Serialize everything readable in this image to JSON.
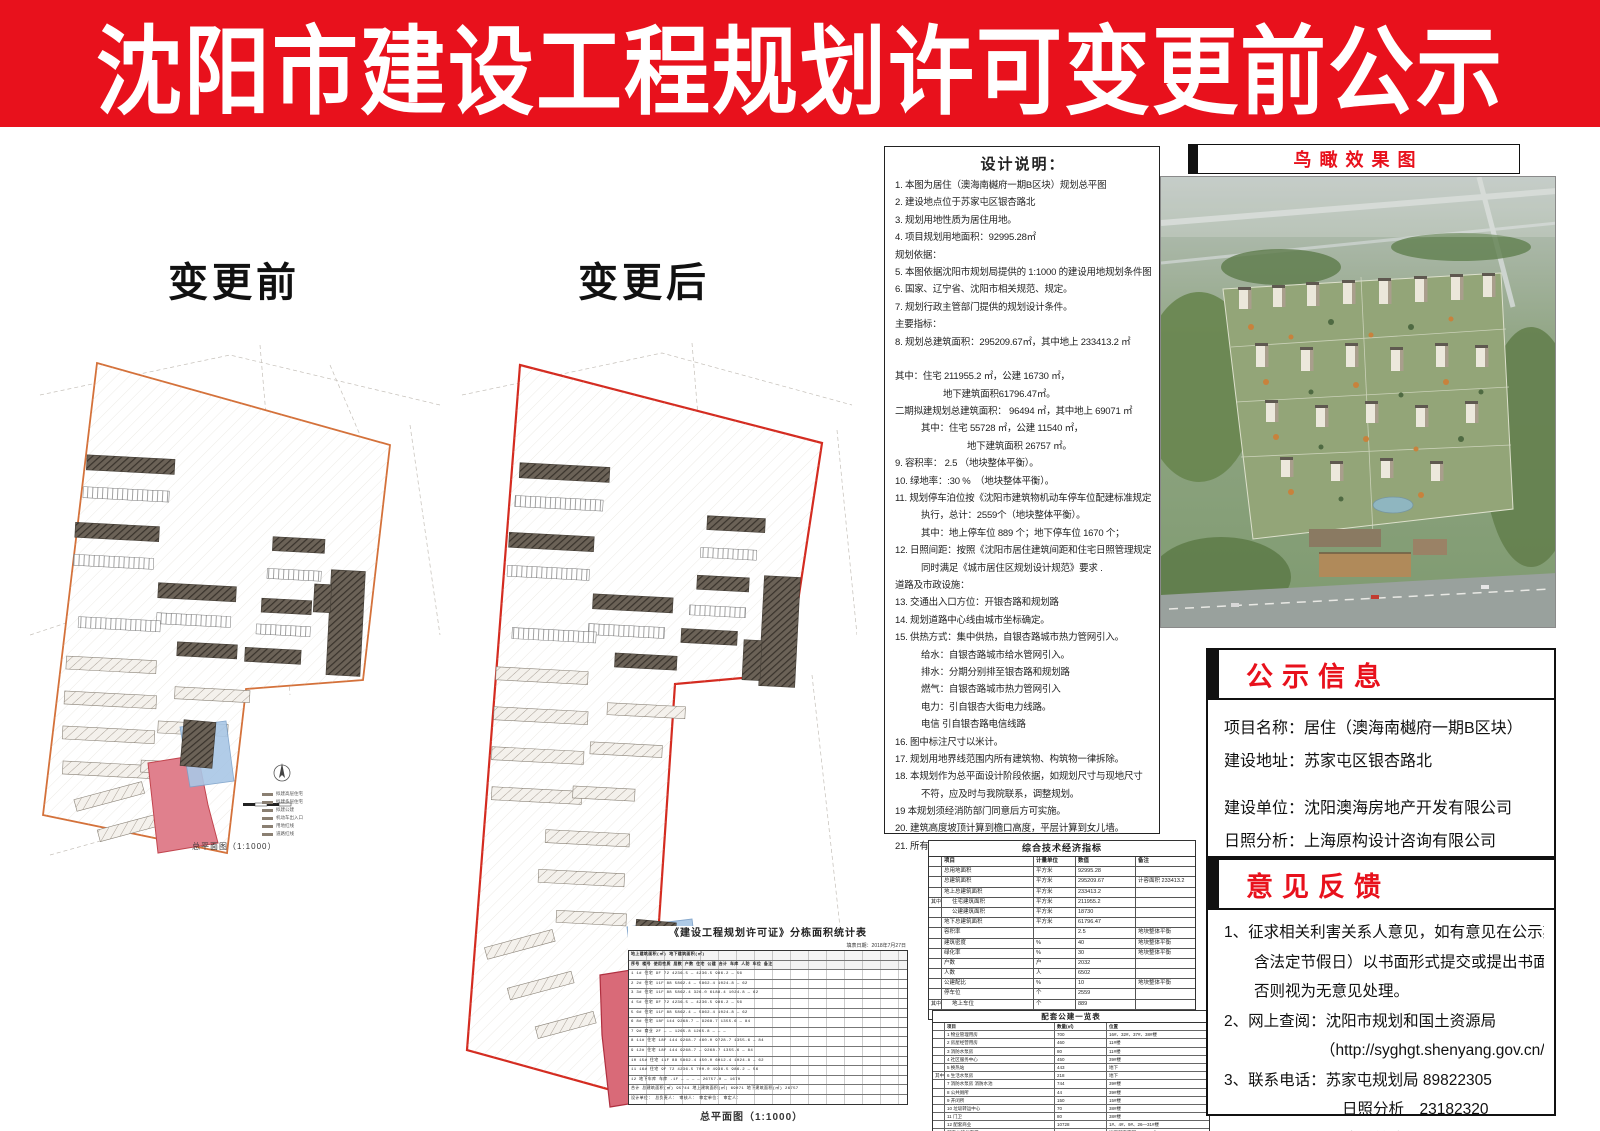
{
  "banner": {
    "title": "沈阳市建设工程规划许可变更前公示"
  },
  "plans": {
    "before_label": "变更前",
    "after_label": "变更后",
    "caption": "总平面图（1:1000）",
    "boundary_color_before": "#d4713a",
    "boundary_color_after": "#d42b20",
    "highlight_red": "#e0808d",
    "highlight_blue": "#a9c7e6",
    "legend": [
      {
        "label": "拟建高层住宅"
      },
      {
        "label": "拟建多层住宅"
      },
      {
        "label": "拟建公建"
      },
      {
        "label": "机动车出入口"
      },
      {
        "label": "用地红线"
      },
      {
        "label": "道路红线"
      }
    ]
  },
  "design_notes": {
    "title": "设计说明：",
    "lines": [
      {
        "t": "1. 本图为居住（澳海南樾府一期B区块）规划总平图",
        "c": ""
      },
      {
        "t": "2. 建设地点位于苏家屯区银杏路北",
        "c": ""
      },
      {
        "t": "3. 规划用地性质为居住用地。",
        "c": ""
      },
      {
        "t": "4. 项目规划用地面积：92995.28㎡",
        "c": ""
      },
      {
        "t": "规划依据：",
        "c": ""
      },
      {
        "t": "5. 本图依据沈阳市规划局提供的 1:1000 的建设用地规划条件图绘制。",
        "c": ""
      },
      {
        "t": "6. 国家、辽宁省、沈阳市相关规范、规定。",
        "c": ""
      },
      {
        "t": "7. 规划行政主管部门提供的规划设计条件。",
        "c": ""
      },
      {
        "t": "主要指标：",
        "c": ""
      },
      {
        "t": "8. 规划总建筑面积：295209.67㎡，其中地上 233413.2 ㎡",
        "c": ""
      },
      {
        "t": "",
        "c": ""
      },
      {
        "t": "其中：住宅 211955.2 ㎡，公建  16730  ㎡，",
        "c": ""
      },
      {
        "t": "地下建筑面积61796.47㎡。",
        "c": "i2"
      },
      {
        "t": "二期拟建规划总建筑面积：  96494  ㎡，其中地上  69071  ㎡",
        "c": ""
      },
      {
        "t": "其中：住宅  55728  ㎡，公建  11540 ㎡，",
        "c": "i1"
      },
      {
        "t": "地下建筑面积  26757  ㎡。",
        "c": "i3"
      },
      {
        "t": "9. 容积率：  2.5  （地块整体平衡）。",
        "c": ""
      },
      {
        "t": "10. 绿地率：:30 %　（地块整体平衡）。",
        "c": ""
      },
      {
        "t": "11. 规划停车泊位按《沈阳市建筑物机动车停车位配建标准规定（试行）》",
        "c": ""
      },
      {
        "t": "执行，总计：2559个（地块整体平衡）。",
        "c": "i1"
      },
      {
        "t": "其中：地上停车位 889 个；地下停车位 1670 个；",
        "c": "i1"
      },
      {
        "t": "12. 日照间距：按照《沈阳市居住建筑间距和住宅日照管理规定》执行",
        "c": ""
      },
      {
        "t": "同时满足《城市居住区规划设计规范》要求 .",
        "c": "i1"
      },
      {
        "t": "道路及市政设施：",
        "c": ""
      },
      {
        "t": "13. 交通出入口方位：开银杏路和规划路",
        "c": ""
      },
      {
        "t": "14. 规划道路中心线由城市坐标确定。",
        "c": ""
      },
      {
        "t": "15. 供热方式：集中供热，自银杏路城市热力管网引入。",
        "c": ""
      },
      {
        "t": "给水：自银杏路城市给水管网引入。",
        "c": "i1"
      },
      {
        "t": "排水：分期分别排至银杏路和规划路",
        "c": "i1"
      },
      {
        "t": "燃气：自银杏路城市热力管网引入",
        "c": "i1"
      },
      {
        "t": "电力：引自银杏大街电力线路。",
        "c": "i1"
      },
      {
        "t": "电信  引自银杏路电信线路",
        "c": "i1"
      },
      {
        "t": "16. 图中标注尺寸以米计。",
        "c": ""
      },
      {
        "t": "17. 规划用地界线范围内所有建筑物、构筑物一律拆除。",
        "c": ""
      },
      {
        "t": "18. 本规划作为总平面设计阶段依据，如规划尺寸与现地尺寸",
        "c": ""
      },
      {
        "t": "不符，应及时与我院联系，调整规划。",
        "c": "i1"
      },
      {
        "t": "19 本规划须经消防部门同意后方可实施。",
        "c": ""
      },
      {
        "t": "20. 建筑高度坡顶计算到檐口高度，平层计算到女儿墙。",
        "c": ""
      },
      {
        "t": "21. 所有消防车道转弯半径均不小于 9 米 .",
        "c": ""
      }
    ]
  },
  "econ_table": {
    "title": "综合技术经济指标",
    "headers": {
      "item": "项目",
      "unit": "计量单位",
      "val": "数值",
      "note": "备注"
    },
    "rows": [
      {
        "g": "",
        "item": "总用地面积",
        "unit": "平方米",
        "val": "92995.28",
        "note": "",
        "ind": ""
      },
      {
        "g": "",
        "item": "总建筑面积",
        "unit": "平方米",
        "val": "295209.67",
        "note": "计容面积 233413.2",
        "ind": ""
      },
      {
        "g": "",
        "item": "地上总建筑面积",
        "unit": "平方米",
        "val": "233413.2",
        "note": "",
        "ind": ""
      },
      {
        "g": "其中",
        "item": "住宅建筑面积",
        "unit": "平方米",
        "val": "211955.2",
        "note": "",
        "ind": "ind"
      },
      {
        "g": "",
        "item": "公建建筑面积",
        "unit": "平方米",
        "val": "18730",
        "note": "",
        "ind": "ind"
      },
      {
        "g": "",
        "item": "地下总建筑面积",
        "unit": "平方米",
        "val": "61796.47",
        "note": "",
        "ind": ""
      },
      {
        "g": "",
        "item": "容积率",
        "unit": "",
        "val": "2.5",
        "note": "地块整体平衡",
        "ind": ""
      },
      {
        "g": "",
        "item": "建筑密度",
        "unit": "%",
        "val": "40",
        "note": "地块整体平衡",
        "ind": ""
      },
      {
        "g": "",
        "item": "绿化率",
        "unit": "%",
        "val": "30",
        "note": "地块整体平衡",
        "ind": ""
      },
      {
        "g": "",
        "item": "户数",
        "unit": "户",
        "val": "2032",
        "note": "",
        "ind": ""
      },
      {
        "g": "",
        "item": "人数",
        "unit": "人",
        "val": "6502",
        "note": "",
        "ind": ""
      },
      {
        "g": "",
        "item": "公建配比",
        "unit": "%",
        "val": "10",
        "note": "地块整体平衡",
        "ind": ""
      },
      {
        "g": "",
        "item": "停车位",
        "unit": "个",
        "val": "2559",
        "note": "",
        "ind": ""
      },
      {
        "g": "其中",
        "item": "地上车位",
        "unit": "个",
        "val": "889",
        "note": "",
        "ind": "ind"
      },
      {
        "g": "",
        "item": "地下车位",
        "unit": "个",
        "val": "1670",
        "note": "",
        "ind": "ind"
      }
    ]
  },
  "support_table": {
    "title": "配套公建一览表",
    "headers": {
      "name": "项目",
      "qty": "数量(㎡)",
      "loc": "位置"
    },
    "rows": [
      {
        "g": "",
        "name": "1 物业管理用房",
        "qty": "700",
        "loc": "16#、32#、37#、38#楼"
      },
      {
        "g": "",
        "name": "2 房屋经营用房",
        "qty": "460",
        "loc": "11#楼"
      },
      {
        "g": "",
        "name": "3 消防水泵房",
        "qty": "80",
        "loc": "11#楼"
      },
      {
        "g": "",
        "name": "4 社区服务中心",
        "qty": "450",
        "loc": "39#楼"
      },
      {
        "g": "",
        "name": "5 换热站",
        "qty": "443",
        "loc": "地下"
      },
      {
        "g": "其中",
        "name": "6 生活水泵房",
        "qty": "218",
        "loc": "地下"
      },
      {
        "g": "",
        "name": "7 消防水泵房 消防水池",
        "qty": "744",
        "loc": "39#楼"
      },
      {
        "g": "",
        "name": "8 公共厕所",
        "qty": "44",
        "loc": "39#楼"
      },
      {
        "g": "",
        "name": "9 开闭所",
        "qty": "150",
        "loc": "15#楼"
      },
      {
        "g": "",
        "name": "10 垃圾转运中心",
        "qty": "70",
        "loc": "38#楼"
      },
      {
        "g": "",
        "name": "11 门卫",
        "qty": "80",
        "loc": "38#楼"
      },
      {
        "g": "",
        "name": "12 配套商业",
        "qty": "10728",
        "loc": "1#、4#、9#、26—31#楼"
      },
      {
        "g": "",
        "name": "配套公建总面积",
        "qty": "26525.4",
        "loc": "地下配套面积 3867.2㎡"
      }
    ]
  },
  "dense_table": {
    "title": "《建设工程规划许可证》分栋面积统计表",
    "date": "填表日期：2018年7月27日",
    "rows": [
      {
        "t": "            地上建筑面积(㎡)              地下建筑面积(㎡)",
        "c": "dh"
      },
      {
        "t": "序号 楼号 使用性质 层数  户数  住宅    公建   合计    车库   人防  车位 备注",
        "c": "dh"
      },
      {
        "t": "1   1#   住宅   9F   72   4236.5   —    4236.5   986.2   —   56",
        "c": ""
      },
      {
        "t": "2   2#   住宅   11F  88   5862.4   —    5862.4  1024.8   —   62",
        "c": ""
      },
      {
        "t": "3   3#   住宅   11F  88   5862.4  326.0  6188.4  1024.8   —   62",
        "c": ""
      },
      {
        "t": "4   5#   住宅   9F   72   4236.5   —    4236.5   986.2   —   56",
        "c": ""
      },
      {
        "t": "5   6#   住宅   11F  88   5862.4   —    5862.4  1024.8   —   62",
        "c": ""
      },
      {
        "t": "6   8#   住宅   18F  144  9268.7   —    9268.7  1355.6   —   84",
        "c": ""
      },
      {
        "t": "7   9#   商业   2F   —     —    1265.8  1265.8    —     —   —",
        "c": ""
      },
      {
        "t": "8   11#  住宅   18F  144  9268.7  460.0  9728.7  1355.6   —   84",
        "c": ""
      },
      {
        "t": "9   12#  住宅   18F  144  9268.7   —    9268.7  1355.6   —   84",
        "c": ""
      },
      {
        "t": "10  15#  住宅   11F  88   5862.4  150.0  6012.4  1024.8   —   62",
        "c": ""
      },
      {
        "t": "11  16#  住宅   9F   72   4236.5  700.0  4936.5   986.2   —   56",
        "c": ""
      },
      {
        "t": "12  地下车库 车库 -1F  —     —      —      —    26757.0  —  1670",
        "c": ""
      },
      {
        "t": "合计  总建筑面积(㎡) 95744   地上建筑面积(㎡) 69071   地下建筑面积(㎡) 26757",
        "c": ""
      },
      {
        "t": "设计单位：        总负责人：        审核人：        审定单位：        审定人：",
        "c": ""
      }
    ]
  },
  "aerial": {
    "title": "鸟瞰效果图"
  },
  "notice_info": {
    "title": "公示信息",
    "rows": [
      {
        "t": "项目名称：居住（澳海南樾府一期B区块）",
        "c": ""
      },
      {
        "t": "建设地址：苏家屯区银杏路北",
        "c": ""
      },
      {
        "t": "",
        "c": "gap"
      },
      {
        "t": "建设单位：沈阳澳海房地产开发有限公司",
        "c": ""
      },
      {
        "t": "日照分析：上海原构设计咨询有限公司",
        "c": ""
      },
      {
        "t": "公示时限：自 2018 年 7 月 20 日起，",
        "c": ""
      },
      {
        "t": "不少于10个工作日",
        "c": "ind"
      }
    ]
  },
  "feedback": {
    "title": "意见反馈",
    "rows": [
      {
        "t": "1、征求相关利害关系人意见，如有意见在公示期内（不",
        "c": ""
      },
      {
        "t": "含法定节假日）以书面形式提交或提出书面听证申请，",
        "c": "ind1"
      },
      {
        "t": "否则视为无意见处理。",
        "c": "ind1"
      },
      {
        "t": "2、网上查阅：沈阳市规划和国土资源局",
        "c": ""
      },
      {
        "t": "（http://syghgt.shenyang.gov.cn/）",
        "c": "ind2"
      },
      {
        "t": "3、联系电话：苏家屯规划局 89822305",
        "c": ""
      },
      {
        "t": "日照分析　23182320",
        "c": "ind3"
      },
      {
        "t": "建设单位　89639999",
        "c": "ind3"
      }
    ]
  },
  "colors": {
    "banner_red": "#e8111c",
    "header_red": "#e8111c"
  }
}
